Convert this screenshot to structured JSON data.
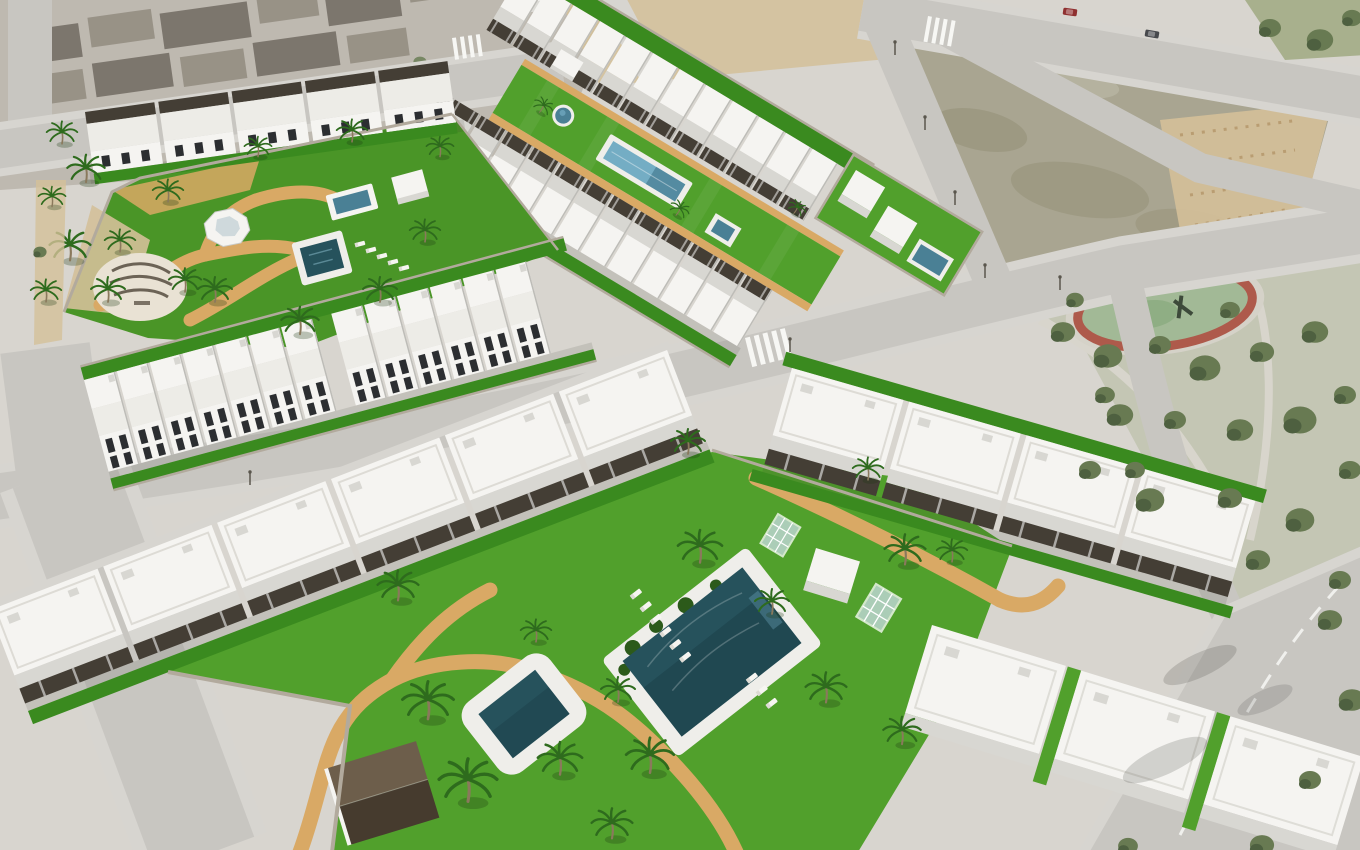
{
  "scene": {
    "type": "aerial 3D architectural render",
    "setting": "masterplan of a new coastal residential development beside an existing town, a vacant lot and a pine park",
    "elements": [
      {
        "name": "existing-town-blocks",
        "position": "top-left",
        "features": [
          "dark pitched roofs",
          "streets",
          "parked cars"
        ]
      },
      {
        "name": "garden-condo-complex",
        "position": "upper-left",
        "features": [
          "central lawn",
          "square pool",
          "raised plunge pool",
          "white faceted canopy",
          "circular cream plaza with dark logo marks",
          "sand paths",
          "palm trees",
          "sun loungers",
          "row of roof-pergola apartments",
          "row of two-storey townhouses"
        ]
      },
      {
        "name": "linear-garden-townhouses",
        "position": "top-center",
        "features": [
          "two parallel townhouse rows with dark roof pergolas",
          "long lawn strip",
          "round pool",
          "lap pool",
          "square plunge pool",
          "corner villas with private pool"
        ]
      },
      {
        "name": "vacant-dirt-lot",
        "position": "top-right",
        "features": [
          "mottled soil",
          "sandy tilled corner",
          "street lights"
        ]
      },
      {
        "name": "pine-park",
        "position": "right",
        "features": [
          "oval red play track",
          "dense pine trees",
          "paths"
        ]
      },
      {
        "name": "large-apartment-complex",
        "position": "bottom-center",
        "features": [
          "big rectangular pool with planted edge",
          "small square pool",
          "sun loungers",
          "winding sand paths",
          "tall palm trees",
          "glass A-frame pergolas",
          "white storage cube",
          "brown-roof cabin",
          "rows of large white blocks with dark pergolas"
        ]
      },
      {
        "name": "road-network",
        "features": [
          "zebra crosswalks",
          "dashed lane line",
          "white lane arrow",
          "street lights",
          "tree shadows on asphalt"
        ]
      }
    ],
    "pool_count": 7,
    "lighting": "bright daylight, sun from upper-right"
  },
  "colors": {
    "base": "#d8d5cf",
    "urbanBase": "#b7b1a8",
    "urbanRoofDark": "#6e675d",
    "urbanRoofMid": "#8d8679",
    "urbanWall": "#dad7d0",
    "road": "#c8c6c1",
    "roadLight": "#d7d5d0",
    "marking": "#f7f7f4",
    "dirt": "#a9a591",
    "dirtDark": "#949076",
    "sand": "#d4c099",
    "park": "#c4c6b4",
    "tree": "#687a52",
    "treeDark": "#4e6040",
    "trackRing": "#ae5a4b",
    "trackInner": "#a2b996",
    "grass": "#4a9527",
    "grassBright": "#51a02c",
    "grassDark": "#3a8a1f",
    "hedge": "#2c5a1a",
    "path": "#d9a965",
    "white": "#f5f4f1",
    "roofWhite": "#edece7",
    "face": "#d8d7d2",
    "faceDark": "#bdbcb7",
    "window": "#2c2e31",
    "pergola": "#443e35",
    "poolDeep": "#26525c",
    "poolDeeper": "#1b3f49",
    "poolMid": "#4a8095",
    "poolLight": "#74adc4",
    "deck": "#efeeea",
    "wall": "#b2aa9d",
    "palm": "#2e6b1d",
    "trunk": "#8a795c",
    "glass": "#c9dde6",
    "brownRoofLight": "#6d5e4b",
    "brownRoofDark": "#463b2e",
    "shadow": "#32322c",
    "carRed": "#8f3030",
    "carDark": "#47494d",
    "carWhite": "#e8e8e6",
    "cornerGrass": "#a8b08d"
  }
}
